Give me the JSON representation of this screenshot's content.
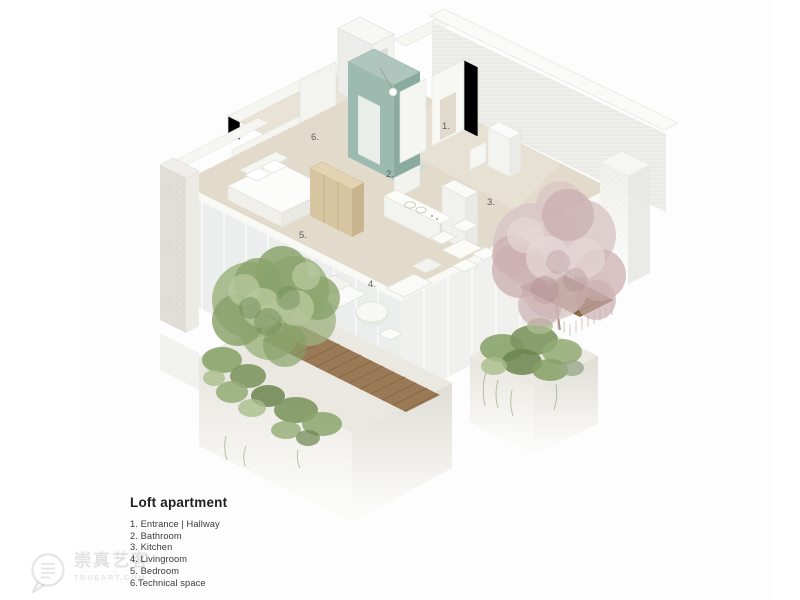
{
  "meta": {
    "kind": "architectural axonometric cutaway diagram of a loft apartment"
  },
  "legend": {
    "title": "Loft apartment",
    "items": [
      "1. Entrance | Hallway",
      "2. Bathroom",
      "3. Kitchen",
      "4. Livingroom",
      "5. Bedroom",
      "6.Technical space"
    ]
  },
  "plan": {
    "labels": [
      {
        "text": "1.",
        "room": "Entrance | Hallway"
      },
      {
        "text": "2.",
        "room": "Bathroom"
      },
      {
        "text": "3.",
        "room": "Kitchen"
      },
      {
        "text": "4.",
        "room": "Livingroom"
      },
      {
        "text": "5.",
        "room": "Bedroom"
      },
      {
        "text": "6.",
        "room": "Technical space"
      }
    ]
  },
  "watermark": {
    "cn": "崇真艺客",
    "site": "TRUEART.COM",
    "icon": "speech-bubble-document-icon"
  },
  "colors": {
    "background": "#fdfdfd",
    "floor_beige": "#e2dbcb",
    "wall_white": "#f6f6f3",
    "wall_gray": "#e9e9e6",
    "bathroom_core_teal": "#9cbab0",
    "wood_wardrobe": "#d7c5a1",
    "wood_deck": "#9a7a56",
    "tree_green": "#8aa46c",
    "tree_pink": "#cdb0b2",
    "concrete": "#e6e4dd",
    "label_gray": "#5c5c5c"
  }
}
